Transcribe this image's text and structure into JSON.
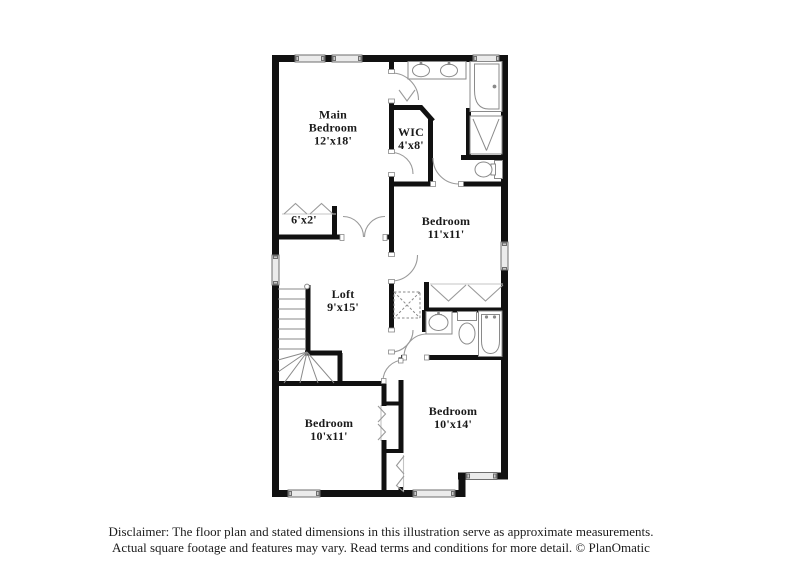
{
  "plan": {
    "rooms": [
      {
        "id": "main-bedroom",
        "name": "Main Bedroom",
        "dims": "12'x18'"
      },
      {
        "id": "wic",
        "name": "WIC",
        "dims": "4'x8'"
      },
      {
        "id": "closet-6x2",
        "name": "",
        "dims": "6'x2'"
      },
      {
        "id": "bedroom-11x11",
        "name": "Bedroom",
        "dims": "11'x11'"
      },
      {
        "id": "loft",
        "name": "Loft",
        "dims": "9'x15'"
      },
      {
        "id": "bedroom-10x11",
        "name": "Bedroom",
        "dims": "10'x11'"
      },
      {
        "id": "bedroom-10x14",
        "name": "Bedroom",
        "dims": "10'x14'"
      }
    ],
    "colors": {
      "wall": "#111111",
      "fixture_line": "#8a8a8a",
      "window_fill": "#ebebeb",
      "background": "#ffffff",
      "text": "#1a1a1a"
    }
  },
  "footer": {
    "line1": "Disclaimer: The floor plan and stated dimensions in this illustration serve as approximate measurements.",
    "line2": "Actual square footage and features may vary. Read terms and conditions for more detail. © PlanOmatic"
  }
}
